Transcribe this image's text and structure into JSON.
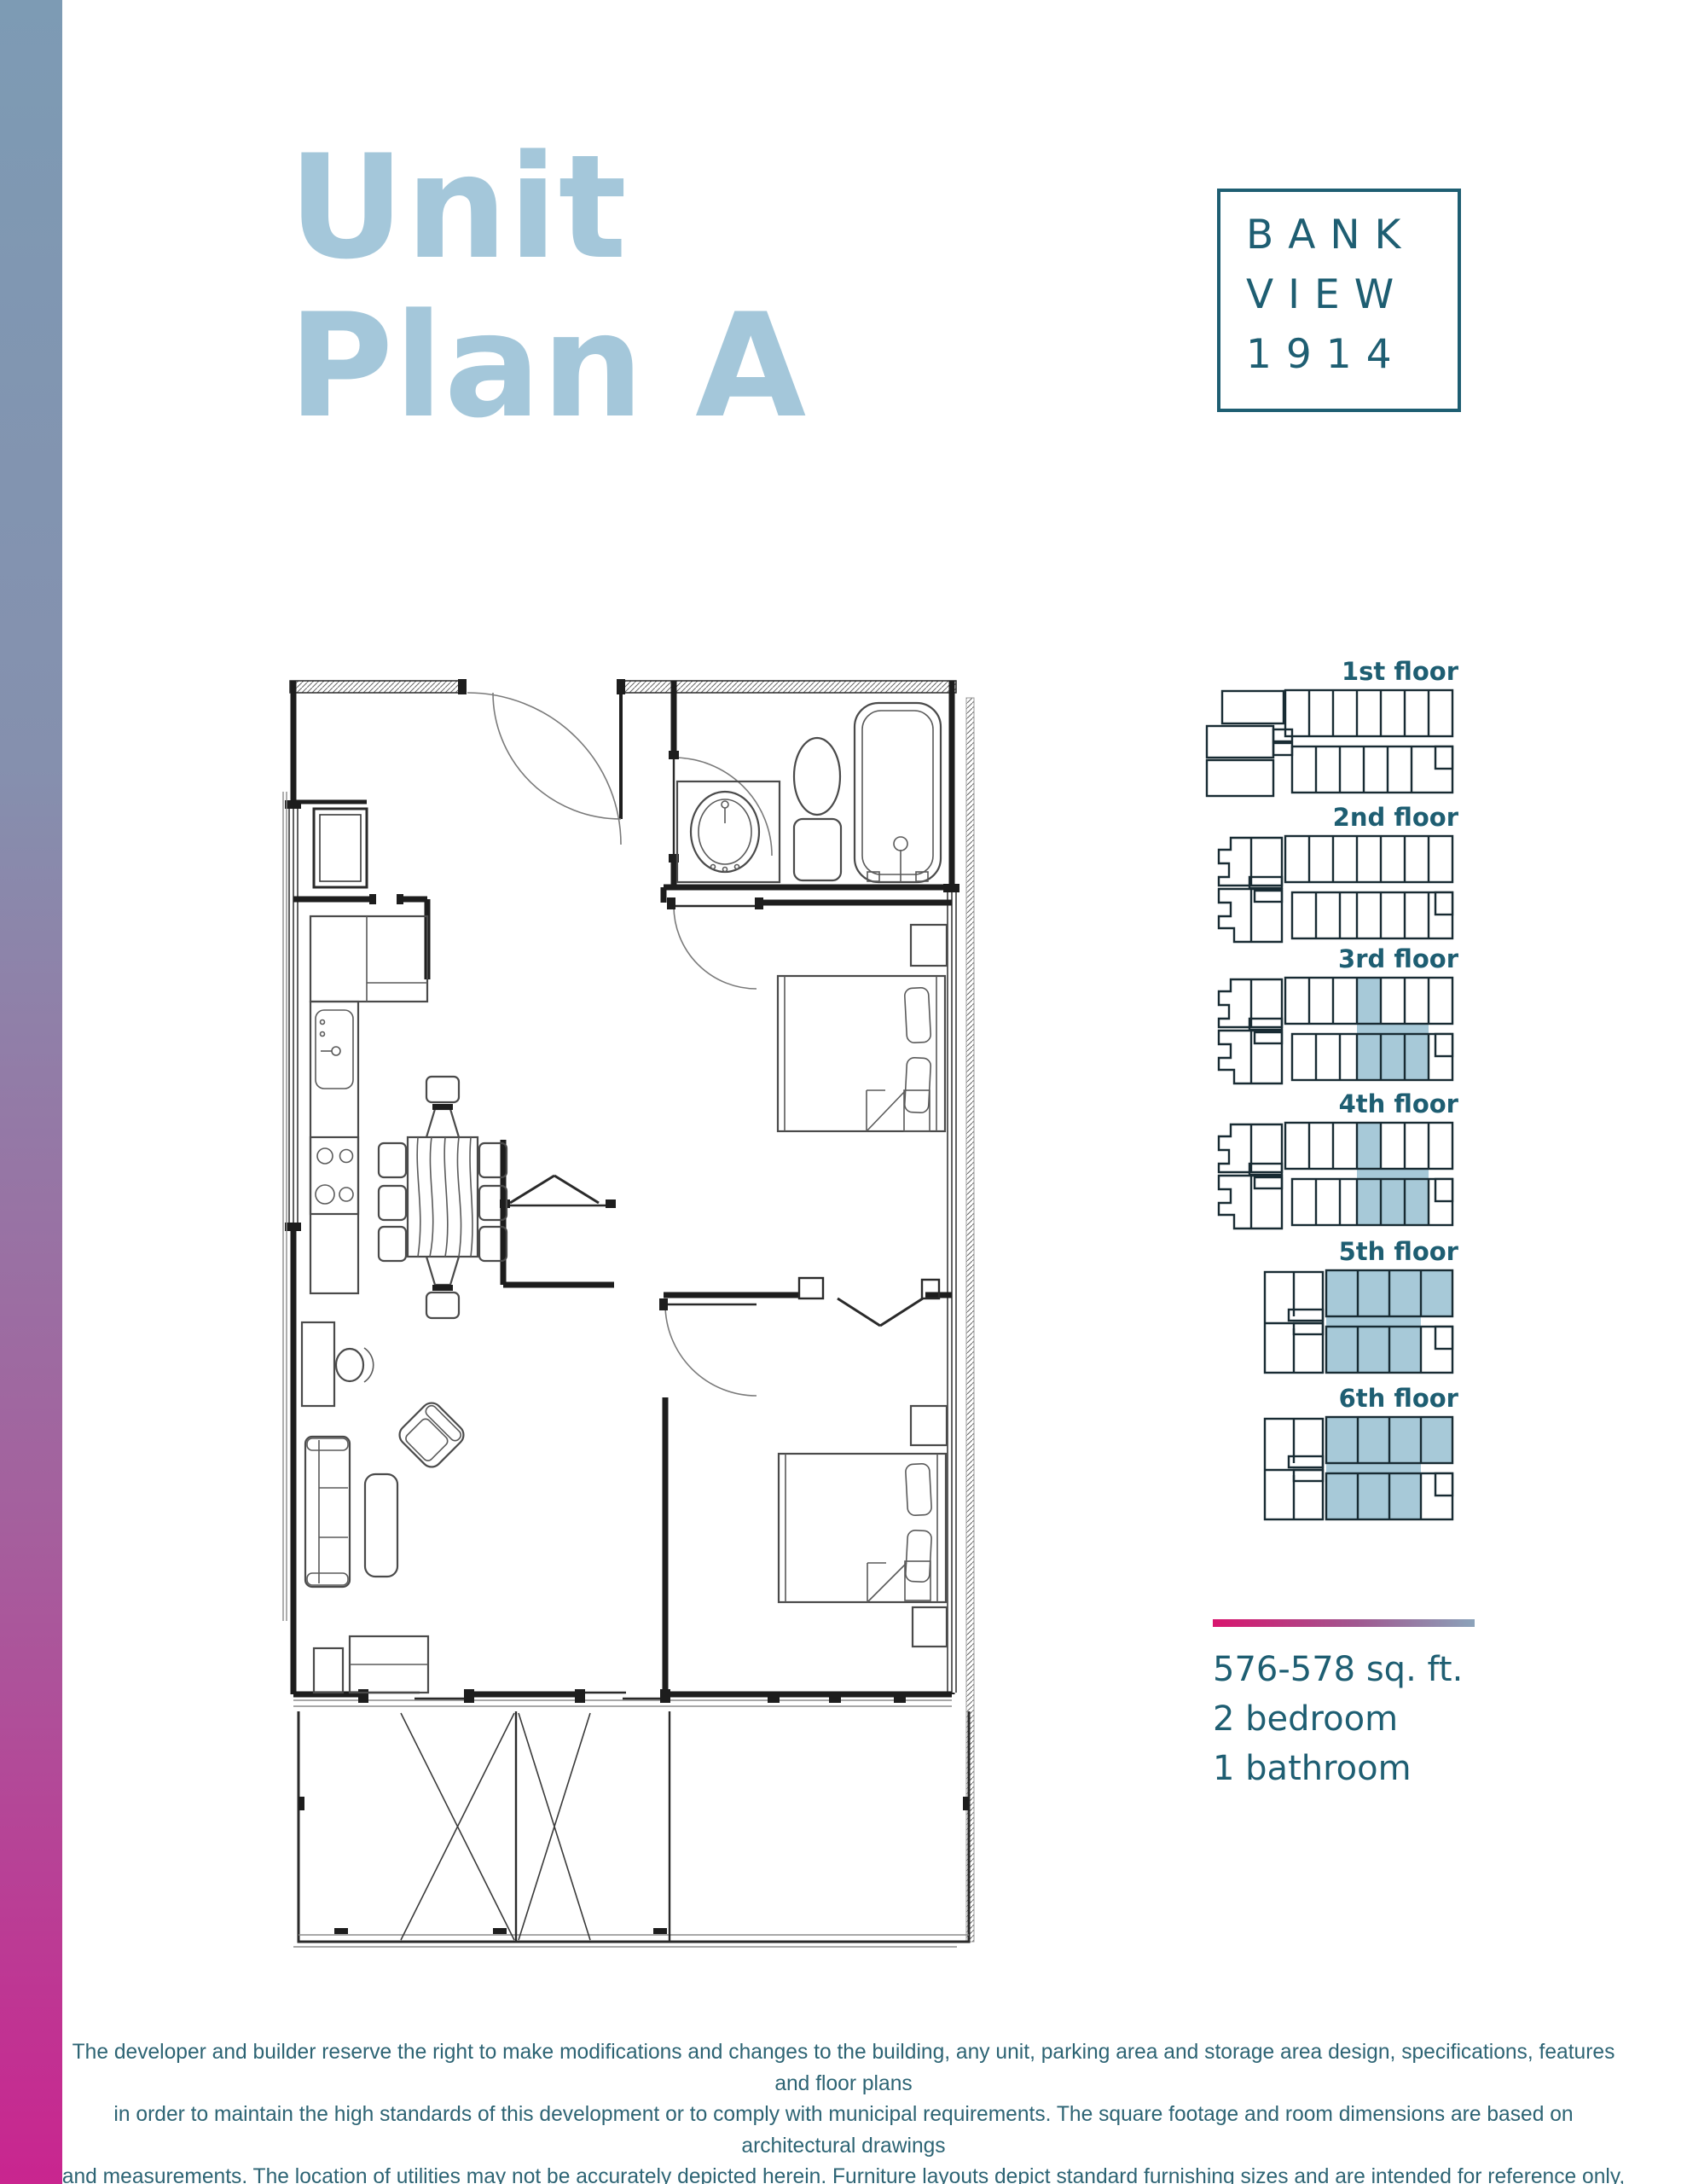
{
  "page": {
    "title_line1": "Unit",
    "title_line2": "Plan A"
  },
  "logo": {
    "line1": "BANK",
    "line2": "VIEW",
    "line3": "1914"
  },
  "floors": [
    {
      "label": "1st floor",
      "type": "first",
      "highlighted": false
    },
    {
      "label": "2nd floor",
      "type": "mid",
      "highlighted": false
    },
    {
      "label": "3rd floor",
      "type": "mid",
      "highlighted": true
    },
    {
      "label": "4th floor",
      "type": "mid",
      "highlighted": true
    },
    {
      "label": "5th floor",
      "type": "upper",
      "highlighted": true
    },
    {
      "label": "6th floor",
      "type": "upper",
      "highlighted": true
    }
  ],
  "stats": {
    "area": "576-578 sq. ft.",
    "bedrooms": "2 bedroom",
    "bathrooms": "1 bathroom"
  },
  "footer": {
    "line1": "The developer and builder reserve the right to make modifications and changes to the building, any unit, parking area and storage area design, specifications, features and floor plans",
    "line2": "in order to maintain the high standards of this development or to comply with municipal requirements. The square footage and room dimensions are based on architectural drawings",
    "line3": "and measurements. The location of utilities may not be accurately depicted herein. Furniture layouts depict standard furnishing sizes and are intended for reference only, all sizes and",
    "line4": "dimensions are approximate and actual area and dimensions may vary from the preliminary plans to the final survey. Errors and omissions accepted"
  },
  "colors": {
    "teal": "#1e5e72",
    "title": "#a4c7da",
    "highlight": "#a7c9d8",
    "grad_top": "#7d9bb4",
    "grad_bottom": "#c9258f",
    "divider_from": "#d8156e",
    "divider_to": "#8ba3ba"
  }
}
